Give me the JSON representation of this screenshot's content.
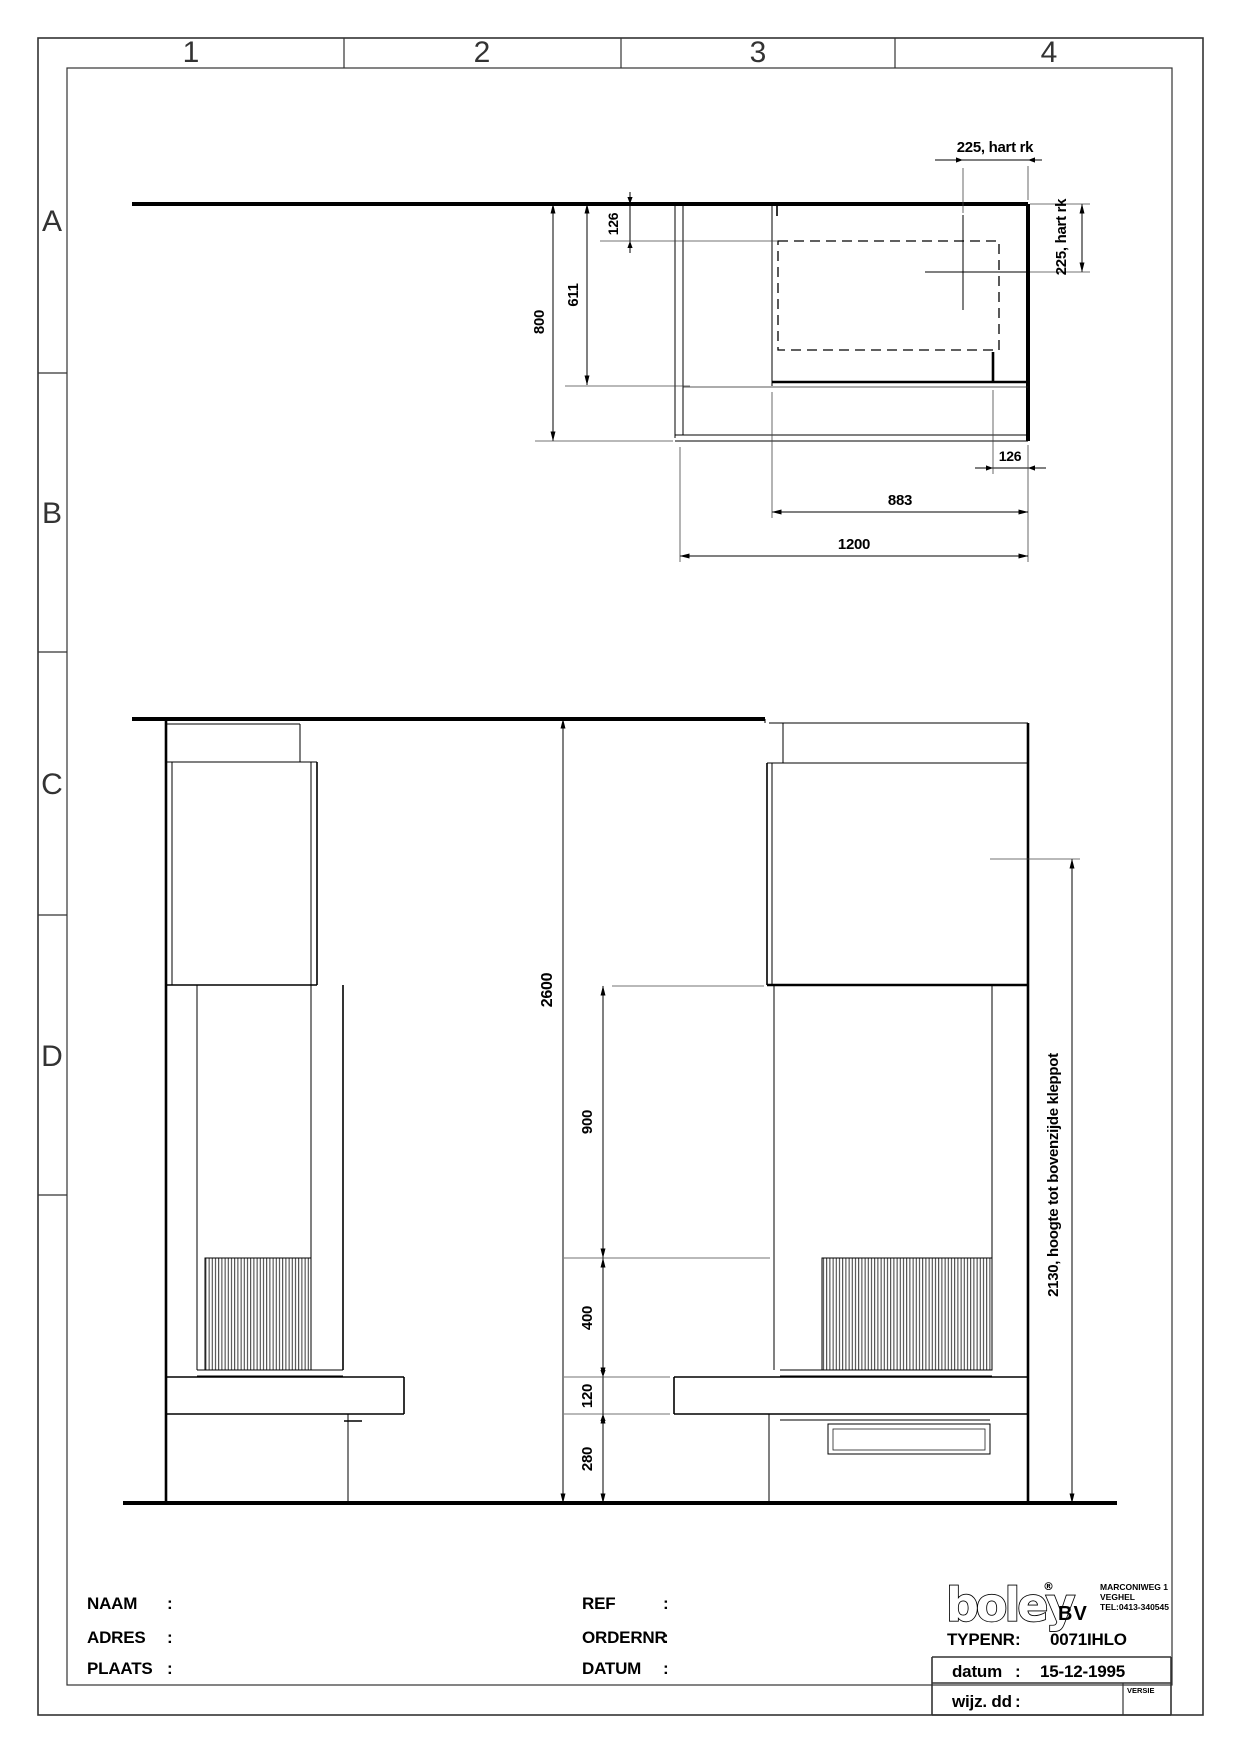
{
  "grid": {
    "cols": [
      "1",
      "2",
      "3",
      "4"
    ],
    "rows": [
      "A",
      "B",
      "C",
      "D"
    ]
  },
  "plan": {
    "dim_hart_top": "225, hart rk",
    "dim_hart_right": "225, hart rk",
    "dim_126_top": "126",
    "dim_611": "611",
    "dim_800": "800",
    "dim_126_bottom": "126",
    "dim_883": "883",
    "dim_1200": "1200"
  },
  "elevation": {
    "dim_2600": "2600",
    "dim_900": "900",
    "dim_400": "400",
    "dim_120": "120",
    "dim_280": "280",
    "dim_2130": "2130, hoogte tot bovenzijde kleppot"
  },
  "titleblock": {
    "naam_label": "NAAM",
    "adres_label": "ADRES",
    "plaats_label": "PLAATS",
    "ref_label": "REF",
    "ordernr_label": "ORDERNR",
    "datum_label": "DATUM",
    "colon": ":",
    "logo_text": "boley",
    "logo_reg": "®",
    "logo_bv": "BV",
    "address_line1": "MARCONIWEG 1",
    "address_line2": "VEGHEL",
    "address_line3": "TEL:0413-340545",
    "typenr_label": "TYPENR",
    "typenr_value": "0071IHLO",
    "datum_row_label": "datum",
    "datum_row_value": "15-12-1995",
    "wijz_label": "wijz. dd",
    "versie_label": "VERSIE"
  }
}
